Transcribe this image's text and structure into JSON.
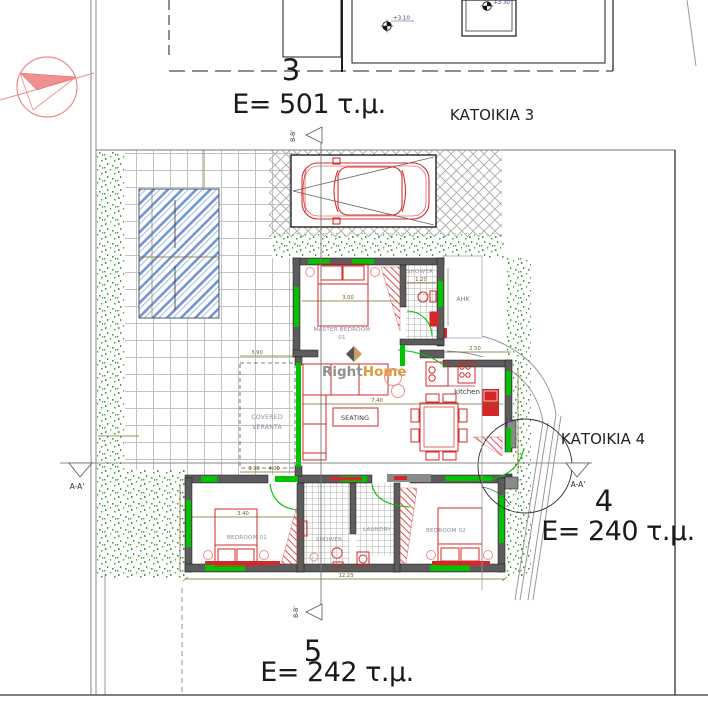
{
  "title_labels": {
    "plot3_number": "3",
    "plot3_area": "E= 501 τ.μ.",
    "plot3_house": "ΚΑΤΟΙΚΙΑ 3",
    "plot4_number": "4",
    "plot4_area": "E= 240 τ.μ.",
    "plot4_house": "ΚΑΤΟΙΚΙΑ 4",
    "plot5_number": "5",
    "plot5_area": "E= 242 τ.μ."
  },
  "levels": {
    "garage_level": "+3.10",
    "upper_level": "+3.30"
  },
  "sections": {
    "aa": "A-A'",
    "bb": "B-B'"
  },
  "rooms": {
    "master_bedroom": "MASTER BEDROOM",
    "master_bedroom_number": "01",
    "shower_top": "SHOWER",
    "ahk": "AHK",
    "kitchen": "kitchen",
    "seating": "SEATING",
    "veranda_line1": "COVERED",
    "veranda_line2": "VERANTA",
    "bedroom1": "BEDROOM 01",
    "shower_bottom": "SHOWER",
    "laundry": "LAUNDRY",
    "bedroom2": "BEDROOM 02"
  },
  "dimensions": {
    "master_bedroom_width": "3.00",
    "shower_width": "1.20",
    "kitchen_width": "2.50",
    "living_width": "7.40",
    "bedroom1_width": "3.40",
    "veranda_width": "3.90",
    "veranda_width2": "4.00",
    "house_total_width": "12.23"
  },
  "watermark": {
    "part1": "Right",
    "part2": "Home"
  },
  "colors": {
    "furniture_red": "#d42828",
    "door_green": "#00c400",
    "pool_blue": "#5b83c9",
    "vegetation_green": "#3f9f3f",
    "wall_gray": "#5c5c5c",
    "dimension_olive": "#7a6a28",
    "compass_red": "#f08080",
    "watermark_orange": "#dd9a3c",
    "level_text_blue": "#3a3a8c"
  }
}
